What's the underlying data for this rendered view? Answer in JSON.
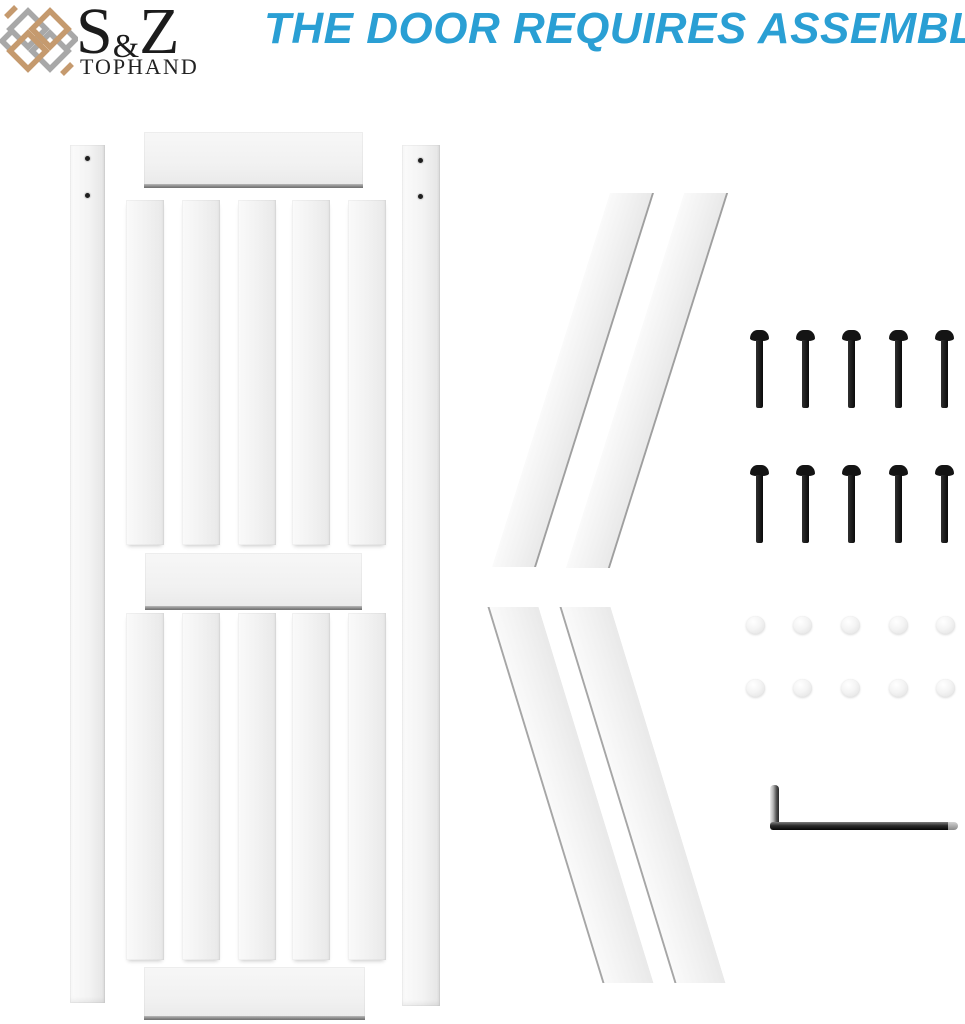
{
  "brand": {
    "name_s": "S",
    "name_amp": "&",
    "name_z": "Z",
    "subtitle": "TOPHAND",
    "lattice_tan_color": "#C59A6E",
    "lattice_gray_color": "#A8A8A8",
    "text_color": "#1c1c1c"
  },
  "heading": {
    "text": "THE DOOR REQUIRES ASSEMBLY",
    "color": "#2A9FD4"
  },
  "kit": {
    "door_panel": {
      "stile_count": 2,
      "rail_count": 3,
      "slat_count_upper": 5,
      "slat_count_lower": 5,
      "screw_hole_count": 4,
      "panel_color": "#F2F2F2"
    },
    "cross_brace_count": 4,
    "bolt_count": 10,
    "cap_count": 10,
    "tool": "allen-wrench",
    "hardware_color": "#141414"
  }
}
